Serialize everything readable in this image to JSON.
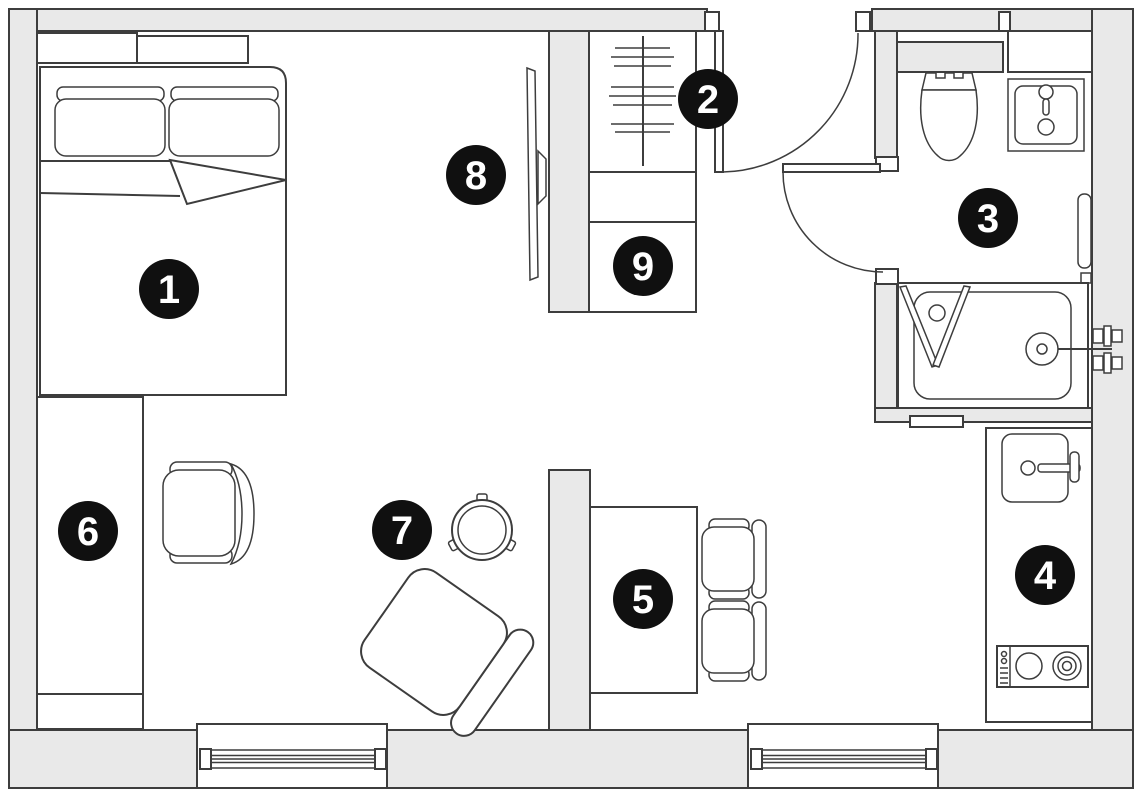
{
  "plan": {
    "type": "apartment-floor-plan",
    "colors": {
      "wall_fill": "#e9e9e9",
      "outline": "#3d3d3d",
      "floor": "#ffffff",
      "marker_bg": "#101010",
      "marker_text": "#ffffff"
    }
  },
  "markers": [
    {
      "label": "1"
    },
    {
      "label": "2"
    },
    {
      "label": "3"
    },
    {
      "label": "4"
    },
    {
      "label": "5"
    },
    {
      "label": "6"
    },
    {
      "label": "7"
    },
    {
      "label": "8"
    },
    {
      "label": "9"
    }
  ]
}
